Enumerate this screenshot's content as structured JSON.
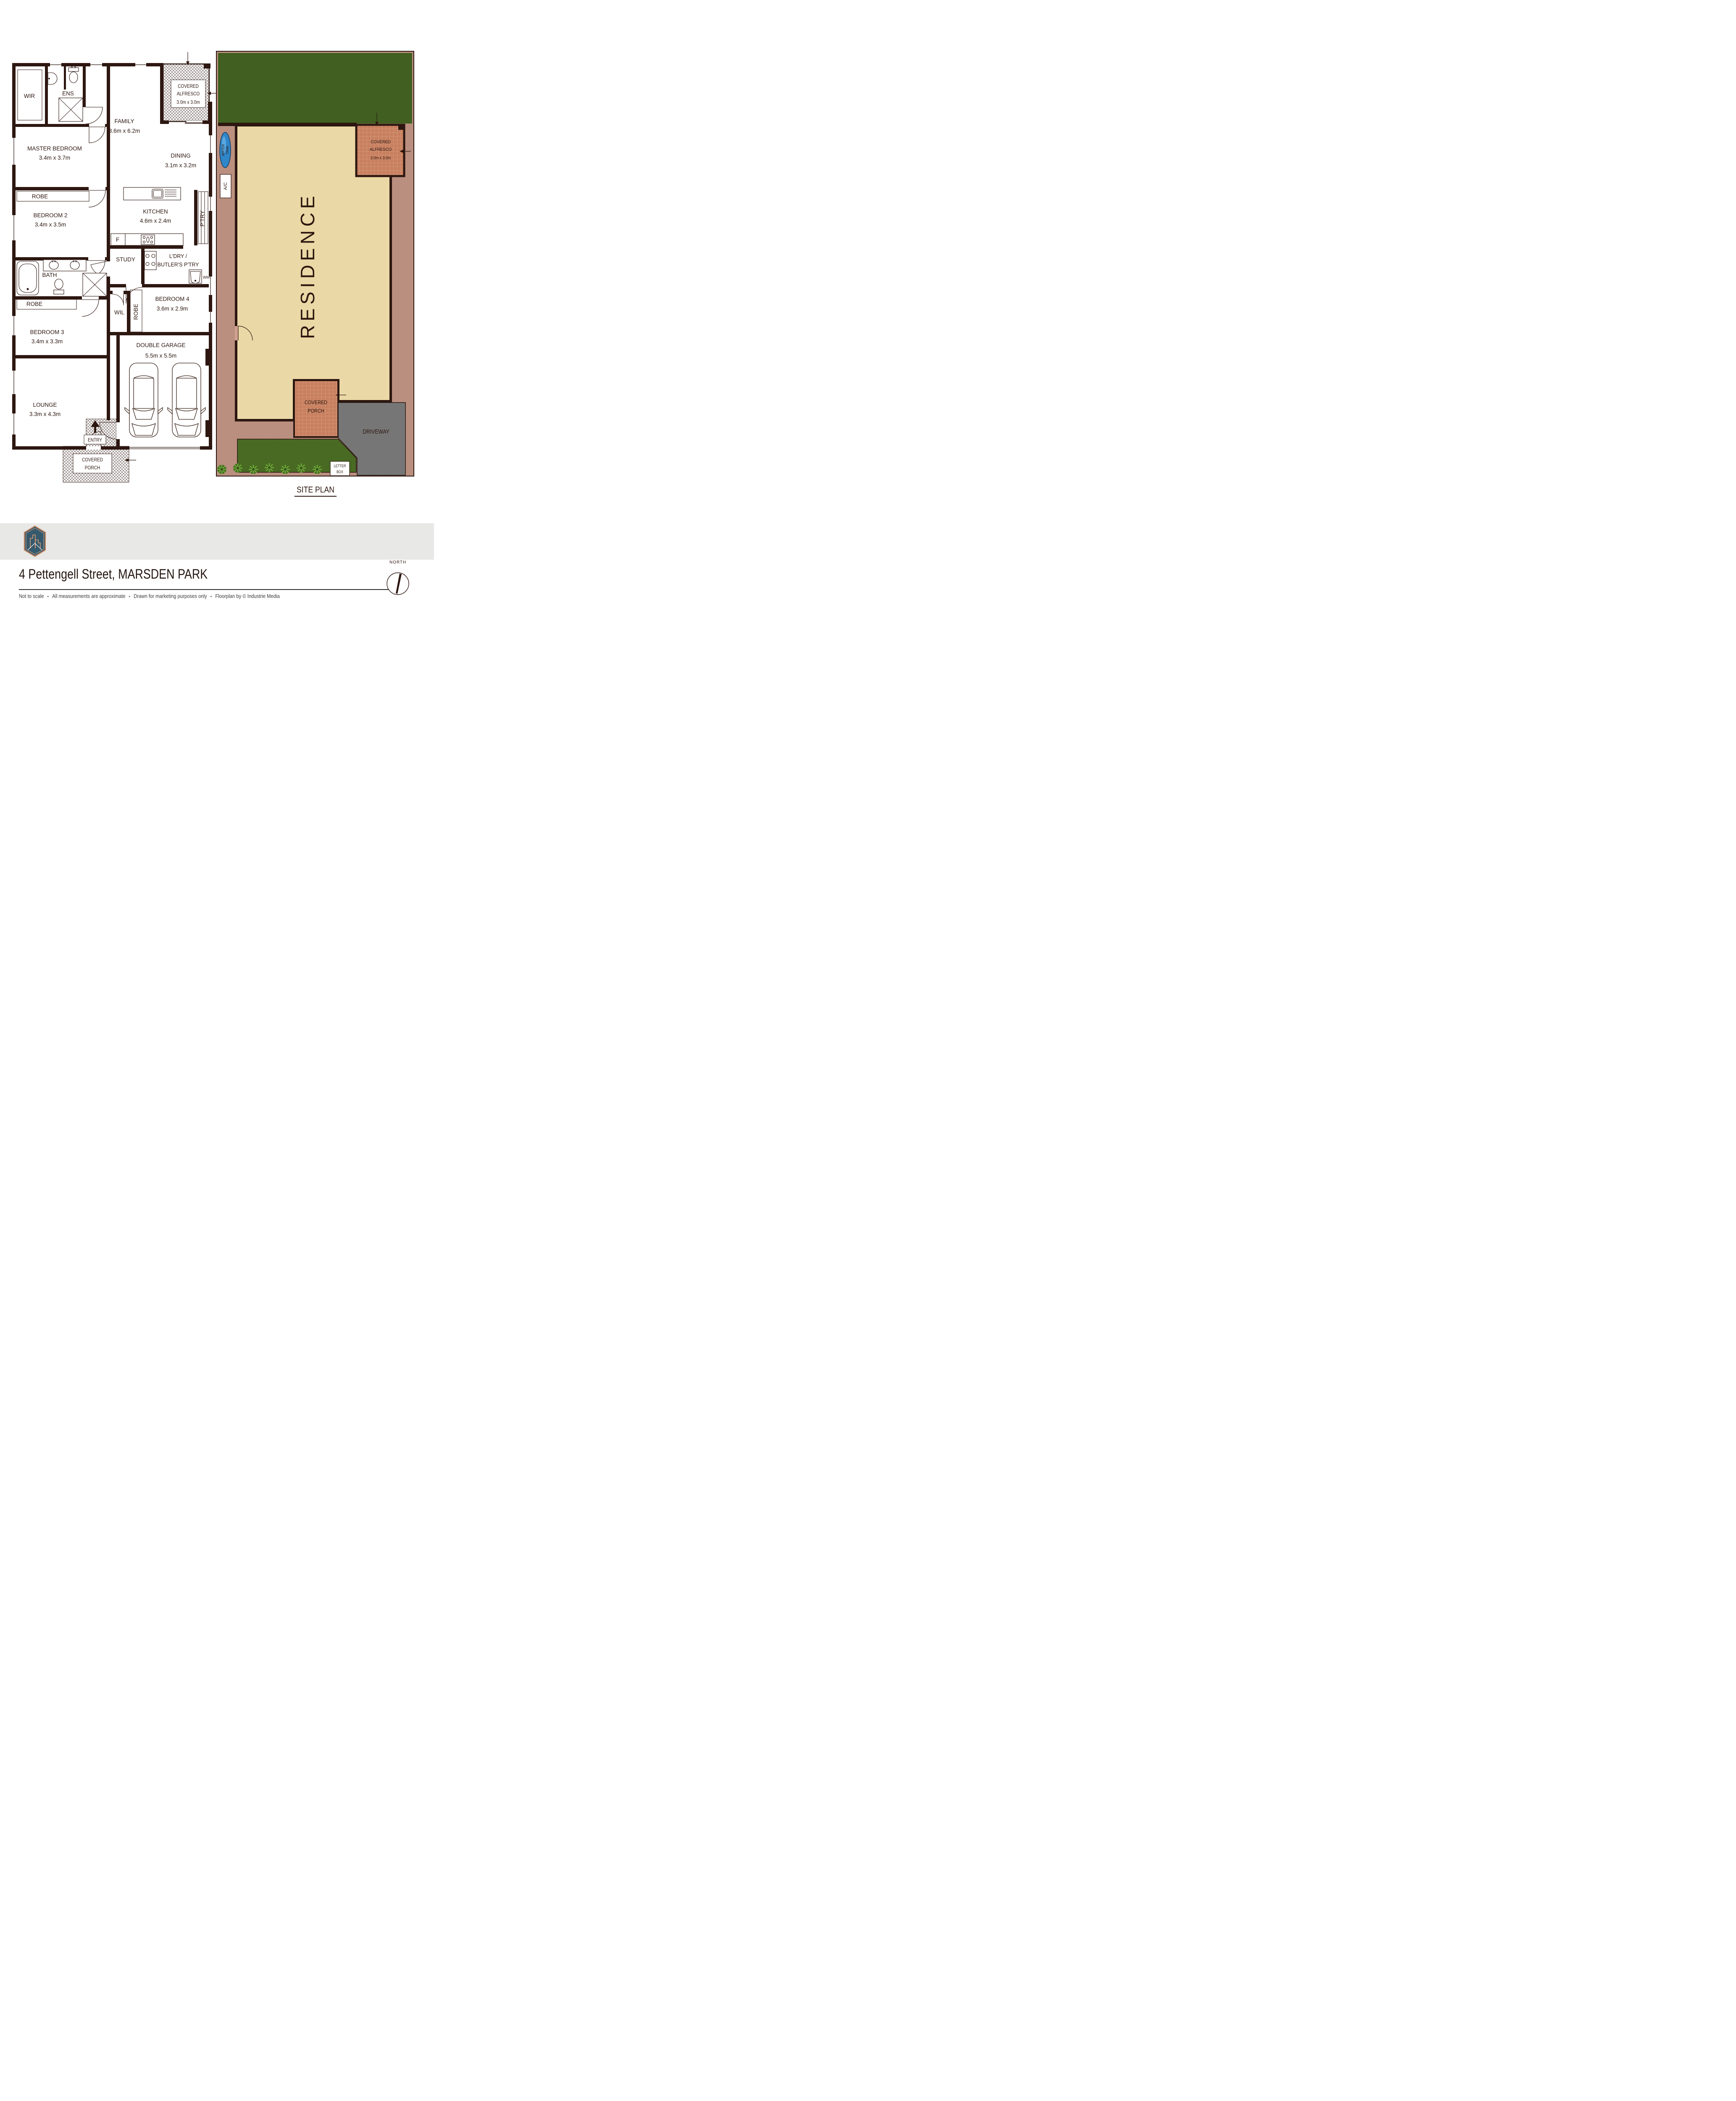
{
  "colors": {
    "wall": "#2d1710",
    "residence_fill": "#ead9a6",
    "site_ground": "#d1a08f",
    "lawn": "#4c7026",
    "tiles": "#c8805f",
    "driveway": "#8e8e8e",
    "footer_band": "#e8e8e6",
    "brand_teal": "#3a6277",
    "logo_copper": "#c9875f",
    "water_tank_blue": "#2f86c8"
  },
  "floorplan": {
    "wir": "WIR",
    "ens": "ENS",
    "master_name": "MASTER BEDROOM",
    "master_dims": "3.4m x 3.7m",
    "family_name": "FAMILY",
    "family_dims": "3.6m x 6.2m",
    "alfresco_l1": "COVERED",
    "alfresco_l2": "ALFRESCO",
    "alfresco_dims": "3.0m x 3.0m",
    "dining_name": "DINING",
    "dining_dims": "3.1m x 3.2m",
    "robe": "ROBE",
    "bedroom2_name": "BEDROOM 2",
    "bedroom2_dims": "3.4m x 3.5m",
    "kitchen_name": "KITCHEN",
    "kitchen_dims": "4.6m x 2.4m",
    "ptry": "P'TRY",
    "fridge": "F",
    "study": "STUDY",
    "laundry_l1": "L'DRY /",
    "laundry_l2": "BUTLER'S P'TRY",
    "wm": "WM",
    "bath": "BATH",
    "bedroom4_name": "BEDROOM 4",
    "bedroom4_dims": "3.6m x 2.9m",
    "wil": "WIL",
    "bedroom3_name": "BEDROOM 3",
    "bedroom3_dims": "3.4m x 3.3m",
    "lounge_name": "LOUNGE",
    "lounge_dims": "3.3m x 4.3m",
    "garage_name": "DOUBLE GARAGE",
    "garage_dims": "5.5m x 5.5m",
    "entry": "ENTRY",
    "porch_l1": "COVERED",
    "porch_l2": "PORCH"
  },
  "siteplan": {
    "title": "SITE PLAN",
    "residence": "RESIDENCE",
    "alfresco_l1": "COVERED",
    "alfresco_l2": "ALFRESCO",
    "alfresco_dims": "3.0m x 3.0m",
    "porch_l1": "COVERED",
    "porch_l2": "PORCH",
    "driveway": "DRIVEWAY",
    "water_tank_l1": "WATER",
    "water_tank_l2": "TANK",
    "ac": "A/C",
    "letterbox_l1": "LETTER",
    "letterbox_l2": "BOX"
  },
  "footer": {
    "brand": "PARAS & BAZ",
    "address": "4 Pettengell Street, MARSDEN PARK",
    "separator": "•",
    "disclaimer": [
      "Not to scale",
      "All measurements are approximate",
      "Drawn for marketing purposes only",
      "Floorplan by © Industrie Media"
    ],
    "north": "NORTH"
  }
}
